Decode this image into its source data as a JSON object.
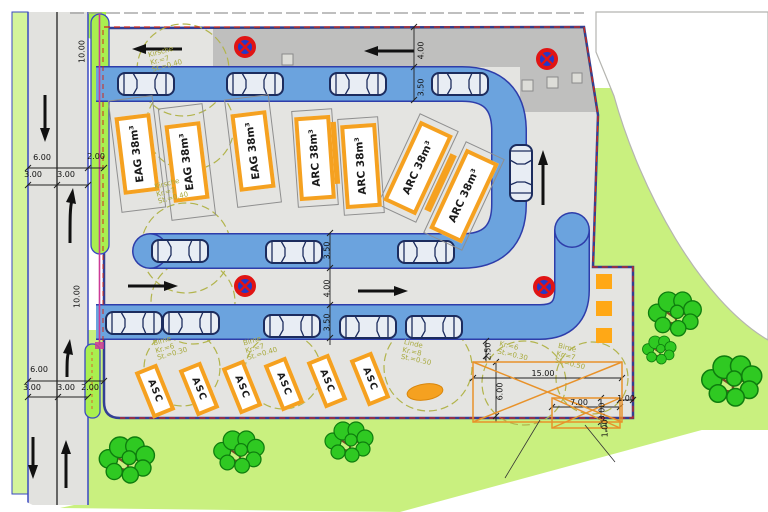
{
  "plan_type": "site-plan",
  "containers": {
    "eag_units": [
      "EAG 38m³",
      "EAG 38m³",
      "EAG 38m³"
    ],
    "arc_units": [
      "ARC 38m³",
      "ARC 38m³",
      "ARC 38m³",
      "ARC 38m³"
    ],
    "asc_units": [
      "ASC",
      "ASC",
      "ASC",
      "ASC",
      "ASC",
      "ASC"
    ]
  },
  "dimensions": {
    "road_width_top": "6.00",
    "road_lane1_top": "3.00",
    "road_lane2_top": "3.00",
    "verge_top": "2.00",
    "segment_top": "10.00",
    "road_width_bottom": "6.00",
    "road_lane1_bottom": "3.00",
    "road_lane2_bottom": "3.00",
    "verge_bottom": "2.00",
    "segment_bottom": "10.00",
    "top_drive_lane": "4.00",
    "top_parking_strip": "3.50",
    "mid_parking_upper": "3.50",
    "mid_drive_lane": "4.00",
    "mid_parking_lower": "3.50",
    "pad_width": "15.00",
    "pad_depth": "6.00",
    "pad_offset": "2.50",
    "inner_pad_width": "7.00",
    "inner_pad_depth": "3.00",
    "inner_offset_right": "1.00",
    "inner_offset_bottom": "1.00"
  },
  "trees": [
    {
      "species": "Kirsche",
      "crown": "Kr.=7",
      "trunk": "St.=0.40"
    },
    {
      "species": "Kirsche",
      "crown": "Kr.=7",
      "trunk": "St.=0.40"
    },
    {
      "species": "Birne",
      "crown": "Kr.=6",
      "trunk": "St.=0.30"
    },
    {
      "species": "Birne",
      "crown": "Kr.=7",
      "trunk": "St.=0.40"
    },
    {
      "species": "Linde",
      "crown": "Kr.=8",
      "trunk": "St.=0.50"
    },
    {
      "species": "",
      "crown": "Kr.=6",
      "trunk": "St.=0.30"
    },
    {
      "species": "Birne",
      "crown": "Kr.=7",
      "trunk": "St.=0.50"
    }
  ],
  "colors": {
    "parking_strip_blue": "#6ba3de",
    "strip_border_navy": "#2e3daa",
    "lawn_green": "#c9f07f",
    "verge_green": "#a9ef4f",
    "pavement_gray": "#e4e4e1",
    "container_orange": "#f5a120",
    "boundary_red": "#d02818",
    "boundary_pink": "#cc3b96",
    "sign_blue": "#2438c8",
    "sign_red": "#e01414",
    "tree_green": "#2fc922",
    "crown_olive": "#b2b44c"
  }
}
